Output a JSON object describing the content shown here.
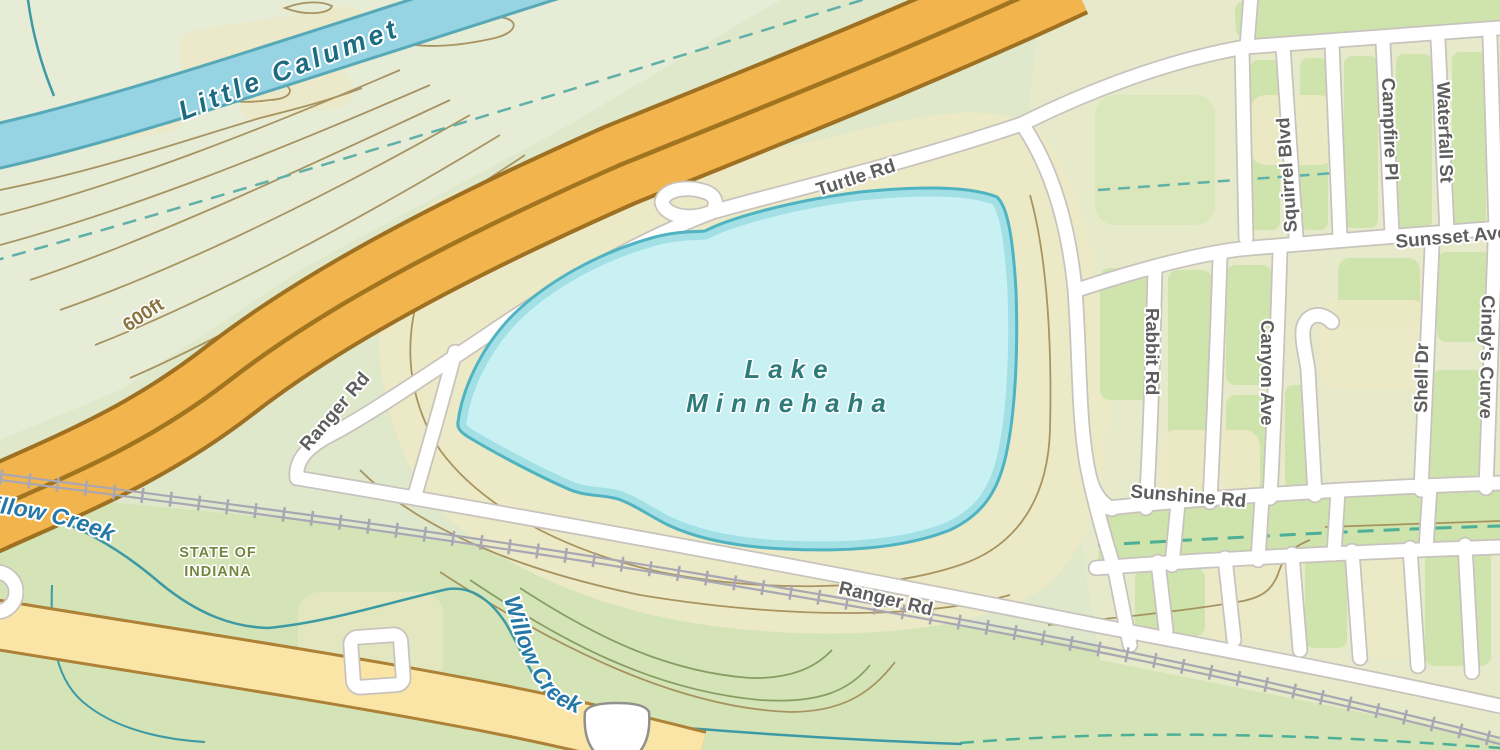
{
  "map": {
    "water_labels": {
      "river": "Little Calumet",
      "creek_west": "Willow Creek",
      "creek_south": "Willow Creek",
      "lake_line1": "Lake",
      "lake_line2": "Minnehaha"
    },
    "road_labels": {
      "turtle": "Turtle Rd",
      "ranger_west": "Ranger Rd",
      "ranger_south": "Ranger Rd",
      "sunshine": "Sunshine Rd",
      "sunsset": "Sunsset Ave",
      "squirrel": "Squirrel Blvd",
      "campfire": "Campfire Pl",
      "waterfall": "Waterfall St",
      "rabbit": "Rabbit Rd",
      "canyon": "Canyon Ave",
      "shell": "Shell Dr",
      "cindys": "Cindy's Curve"
    },
    "place_labels": {
      "state_line1": "STATE OF",
      "state_line2": "INDIANA"
    },
    "contour_label": "600ft",
    "route_shield": "33",
    "colors": {
      "land_base": "#dfe8cb",
      "land_pale": "#e6ecd6",
      "land_beige": "#ece9c6",
      "land_green": "#cfe3ad",
      "land_green_deep": "#d4e3b4",
      "lake_fill": "#c9f1f3",
      "lake_rim": "#a2e0e6",
      "lake_edge": "#4fb3c1",
      "river_fill": "#96d3e3",
      "river_edge": "#57a9b7",
      "stream": "#45a5a0",
      "stream_dashed": "#5fb0a8",
      "motorway_fill": "#f2b44c",
      "motorway_casing": "#9e7022",
      "motorway_center": "#a1751f",
      "secondary_fill": "#fae5a6",
      "secondary_casing": "#ad8136",
      "road_fill": "#ffffff",
      "road_casing": "#c8c3bd",
      "rail": "#a9a7b3",
      "contour": "#a18b56",
      "gully_green": "#7d9155",
      "label_road": "#5e5e5e",
      "label_water": "#2578a6",
      "label_lake": "#2e7b7c",
      "label_state": "#75843e",
      "label_contour": "#8a7340"
    }
  }
}
